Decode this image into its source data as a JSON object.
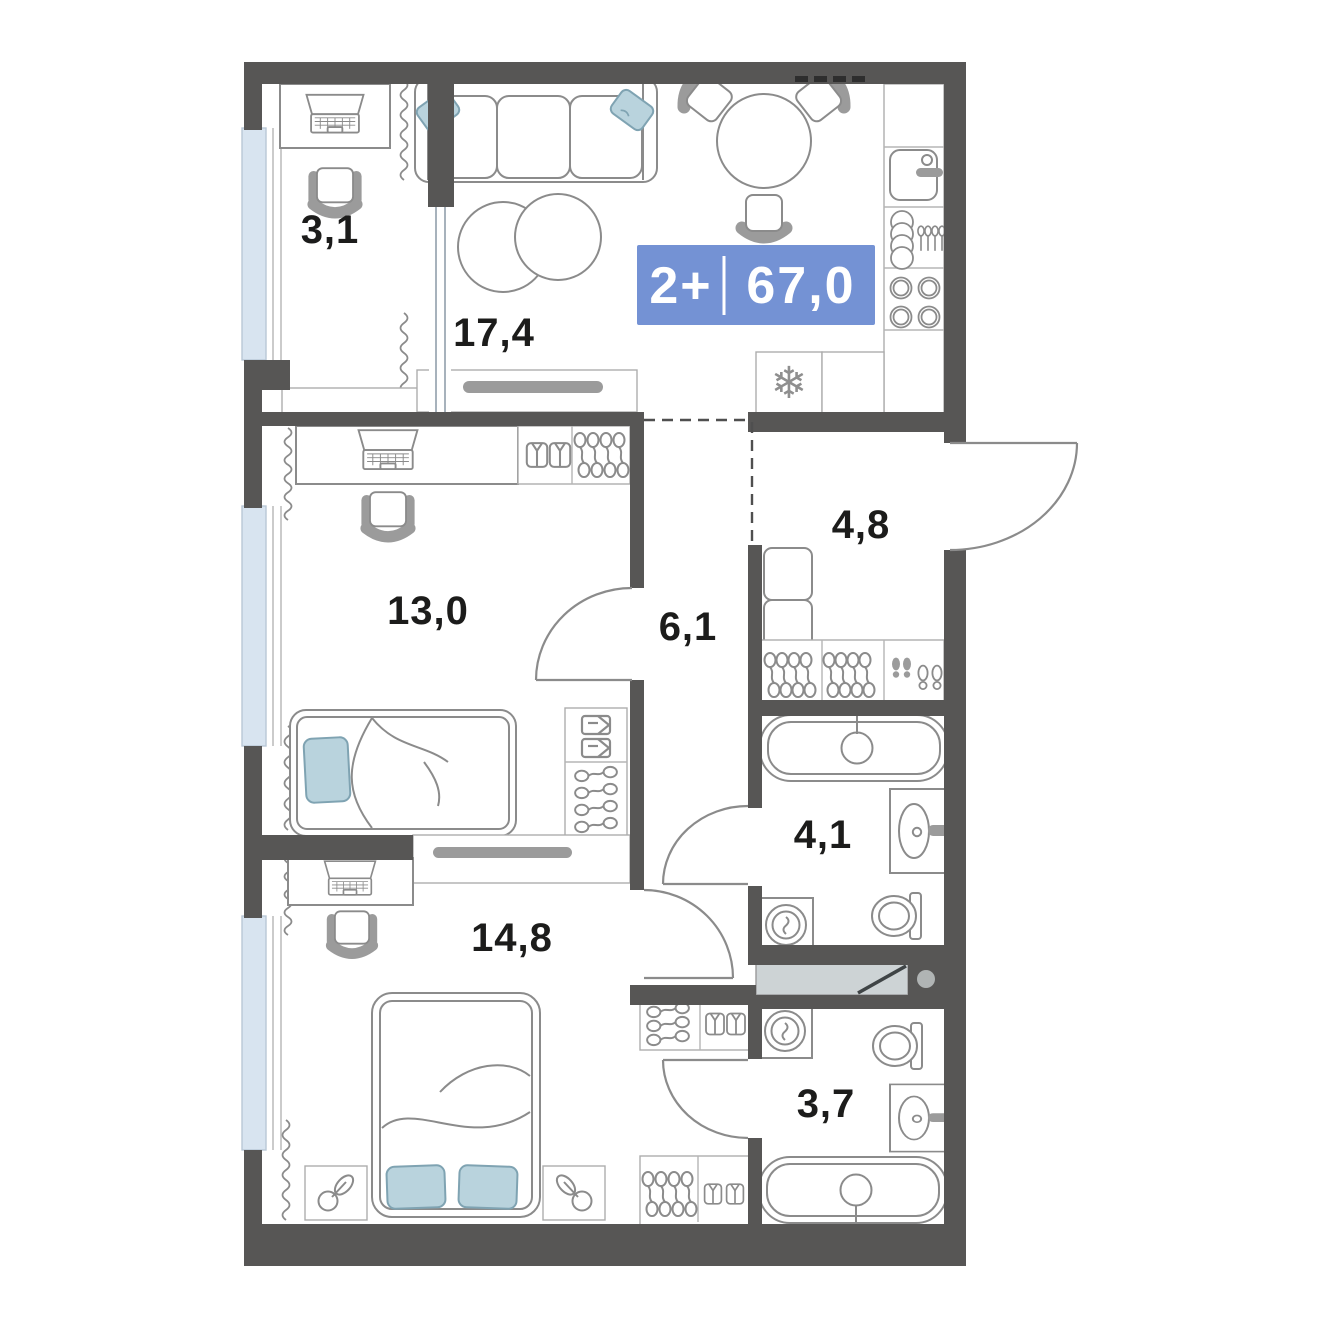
{
  "plan": {
    "badge": {
      "rooms": "2+",
      "area": "67,0"
    },
    "labels": {
      "balcony": "3,1",
      "living": "17,4",
      "bedroom1": "13,0",
      "hall": "6,1",
      "entry": "4,8",
      "bath1": "4,1",
      "bedroom2": "14,8",
      "bath2": "3,7"
    },
    "icons": {
      "snowflake": "❄"
    },
    "colors": {
      "wall": "#575655",
      "badge": "#7492d4",
      "furniture_line": "#8b8b8b",
      "window": "#d8e4f0",
      "pillow": "#b9d3dd",
      "shaft": "#cdd3d5"
    }
  }
}
